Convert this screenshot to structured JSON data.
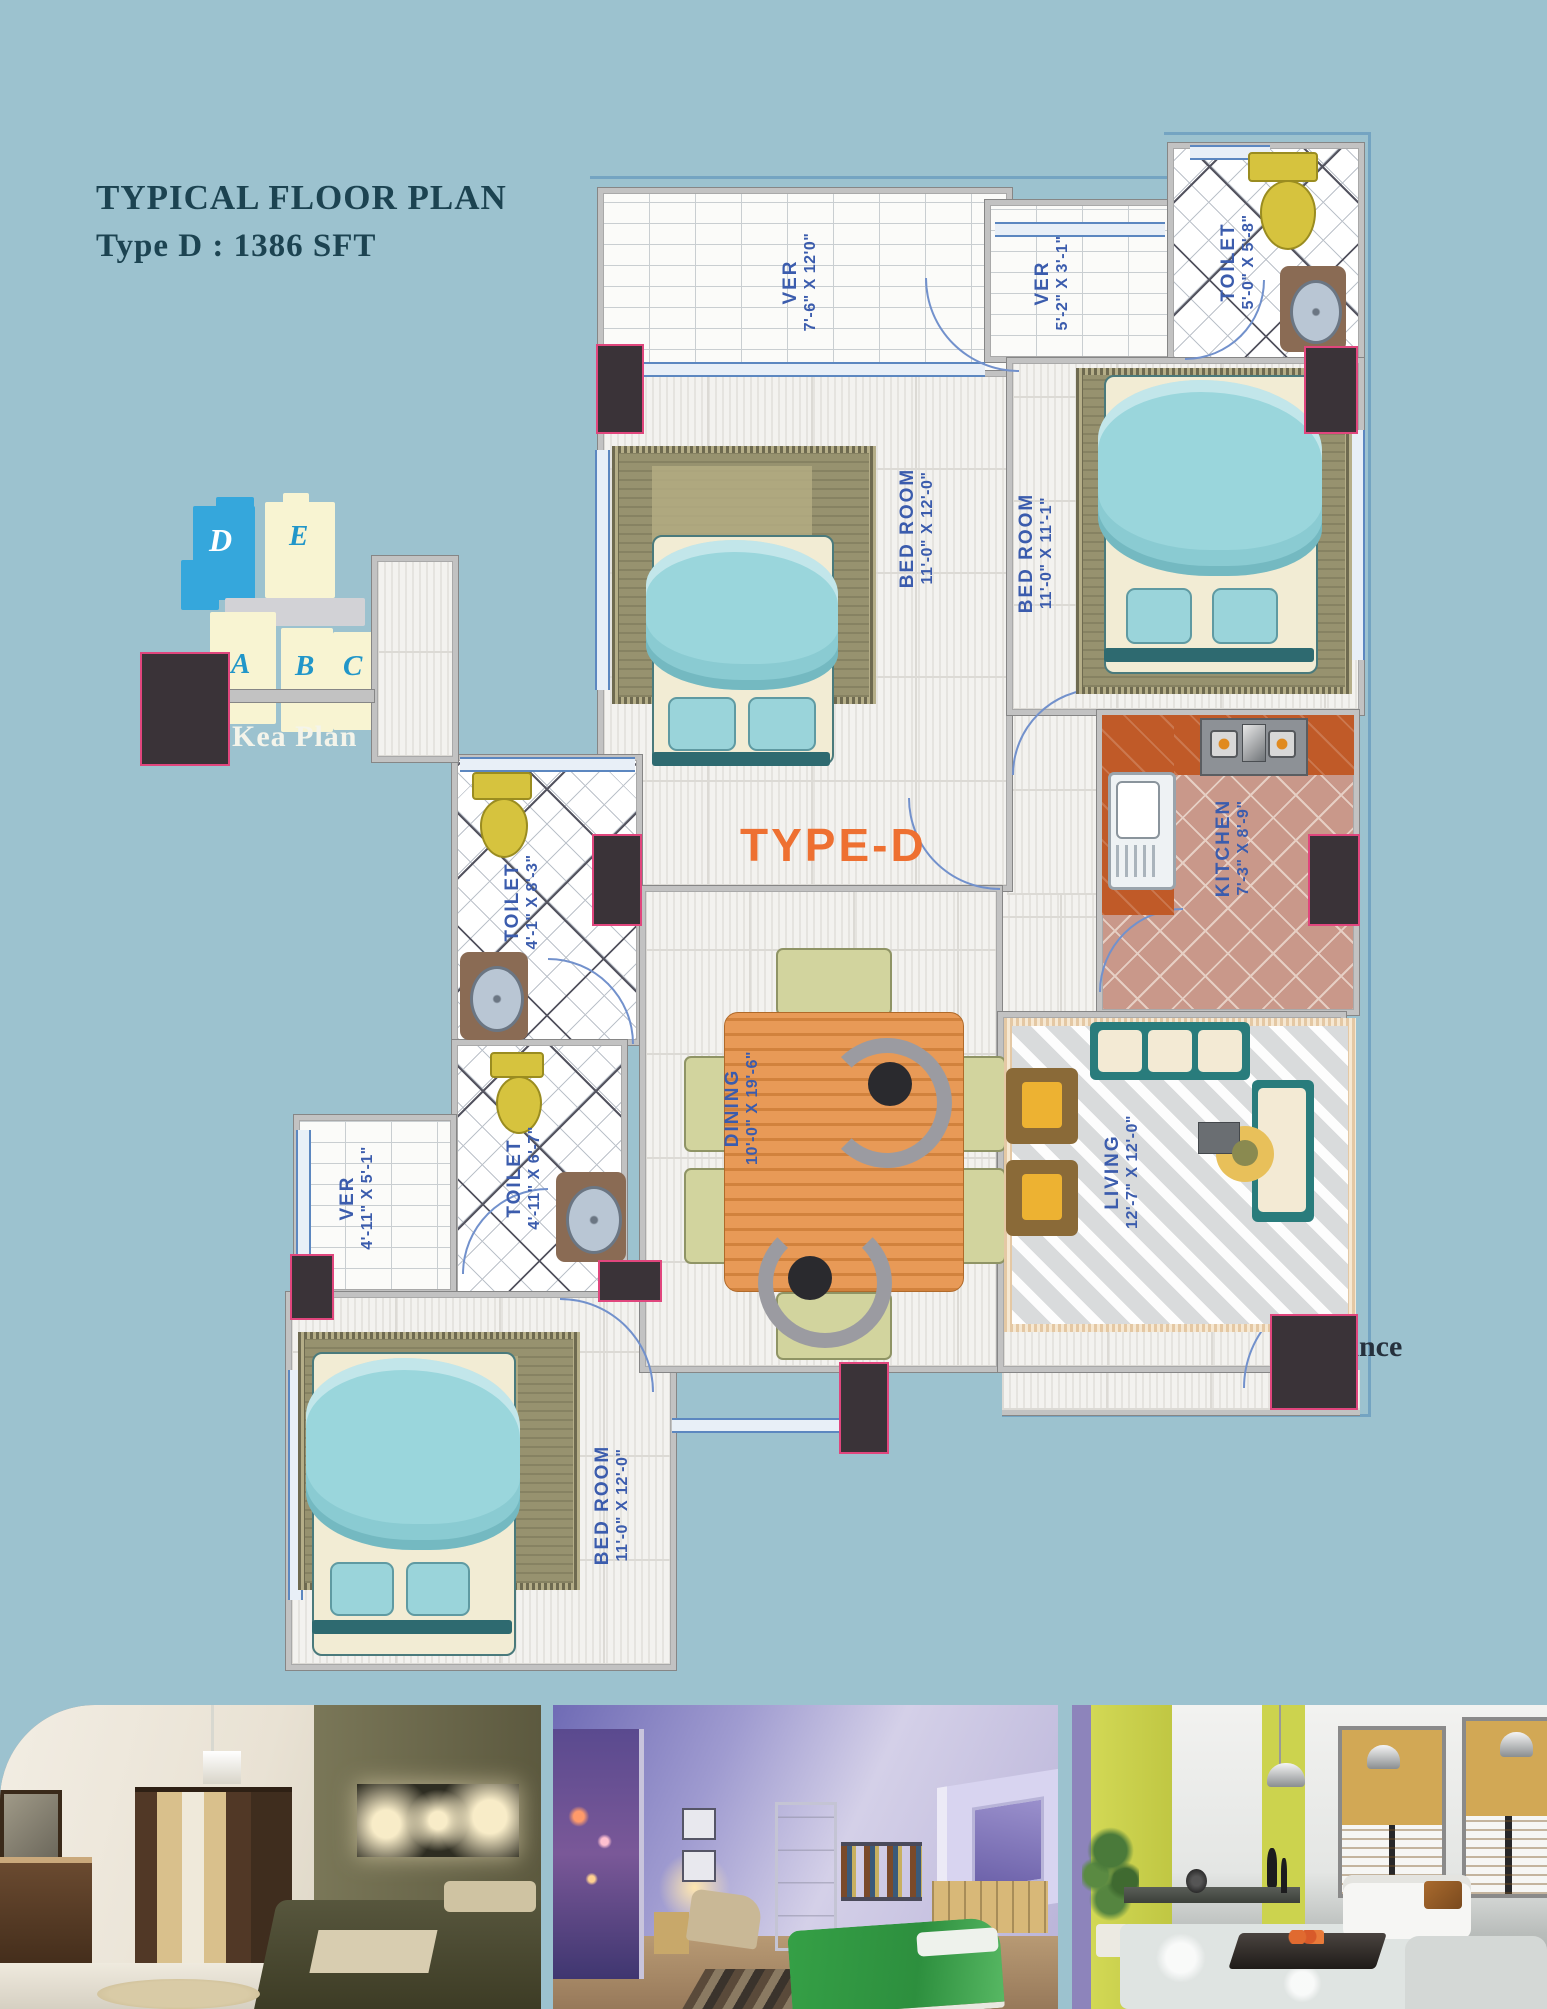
{
  "title": {
    "line1": "TYPICAL  FLOOR PLAN",
    "line2": "Type D : 1386  SFT"
  },
  "key_plan": {
    "label": "Kea Plan",
    "blocks": [
      {
        "id": "D",
        "highlighted": true
      },
      {
        "id": "E",
        "highlighted": false
      },
      {
        "id": "A",
        "highlighted": false
      },
      {
        "id": "B",
        "highlighted": false
      },
      {
        "id": "C",
        "highlighted": false
      }
    ]
  },
  "plan": {
    "type_label": "TYPE-D",
    "entrance_label": "Entrance",
    "rooms": [
      {
        "id": "ver-top",
        "name": "VER",
        "dim": "7'-6\" X 12'0\""
      },
      {
        "id": "ver-right",
        "name": "VER",
        "dim": "5'-2\" X 3'-1\""
      },
      {
        "id": "toilet-top",
        "name": "TOILET",
        "dim": "5'-0\" X 5'-8\""
      },
      {
        "id": "bed-top",
        "name": "BED ROOM",
        "dim": "11'-0\" X 12'-0\""
      },
      {
        "id": "bed-right",
        "name": "BED ROOM",
        "dim": "11'-0\" X 11'-1\""
      },
      {
        "id": "kitchen",
        "name": "KITCHEN",
        "dim": "7'-3\" X 8'-9\""
      },
      {
        "id": "toilet-mid",
        "name": "TOILET",
        "dim": "4'-1\" X 8'-3\""
      },
      {
        "id": "toilet-low",
        "name": "TOILET",
        "dim": "4'-11\" X 6'-7\""
      },
      {
        "id": "ver-left",
        "name": "VER",
        "dim": "4'-11\" X 5'-1\""
      },
      {
        "id": "bed-bottom",
        "name": "BED ROOM",
        "dim": "11'-0\" X 12'-0\""
      },
      {
        "id": "dining",
        "name": "DINING",
        "dim": "10'-0\" X 19'-6\""
      },
      {
        "id": "living",
        "name": "LIVING",
        "dim": "12'-7\" X 12'-0\""
      }
    ]
  },
  "photos": [
    {
      "alt": "bedroom interior render"
    },
    {
      "alt": "attic bedroom interior render"
    },
    {
      "alt": "living room interior render"
    }
  ],
  "colors": {
    "background": "#9cc2cf",
    "title_text": "#1c4351",
    "room_label_blue": "#3b5cad",
    "accent_orange": "#ee7031",
    "keyplan_highlight_blue": "#35a7dc",
    "keyplan_block_cream": "#f8f4d2",
    "wall_gray": "#c2c2c2",
    "column_fill": "#3a3338",
    "column_outline": "#e0467d",
    "bed_blanket_teal": "#9ad6dc",
    "kitchen_counter_orange": "#c05a28",
    "fixture_yellow": "#d6c33e"
  }
}
